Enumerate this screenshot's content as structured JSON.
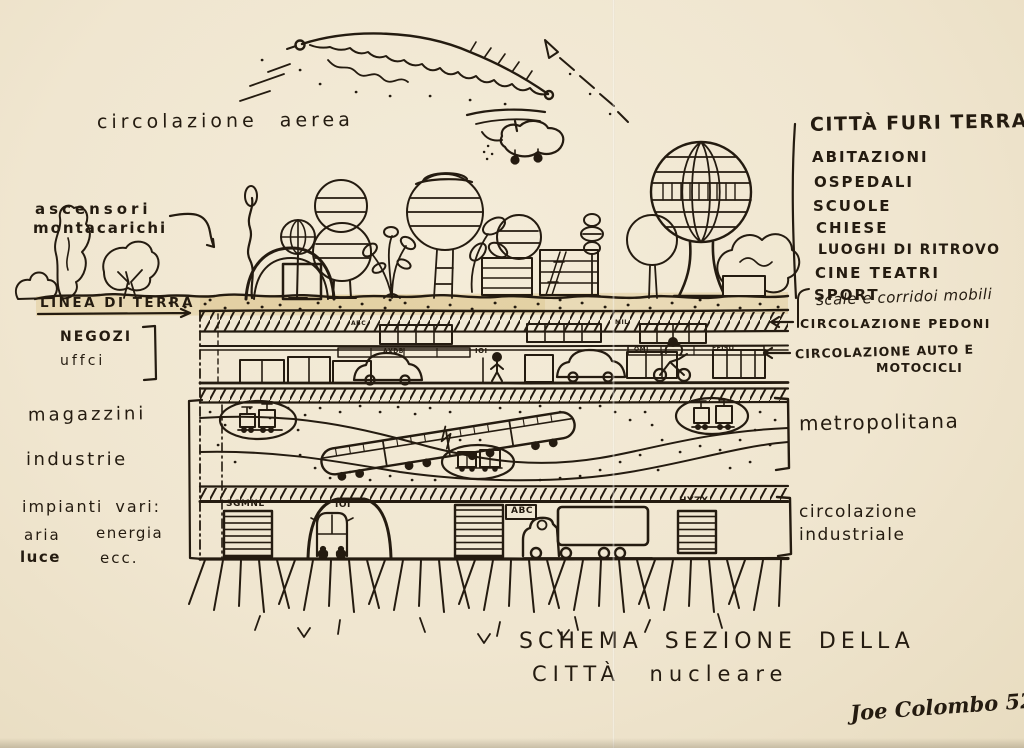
{
  "palette": {
    "paper": "#f1e7d2",
    "ink": "#241b10",
    "highlight": "#dfc995"
  },
  "sky": {
    "air_circulation": "circolazione aerea"
  },
  "above_ground": {
    "heading": "CITTÀ FURI TERRA",
    "items": [
      "ABITAZIONI",
      "OSPEDALI",
      "SCUOLE",
      "CHIESE",
      "LUOGHI DI RITROVO",
      "CINE TEATRI",
      "SPORT"
    ]
  },
  "left_annotations": {
    "elevators_line1": "ascensori",
    "elevators_line2": "montacarichi",
    "ground_line": "LINEA DI TERRA",
    "shops_line1": "NEGOZI",
    "shops_line2": "uffci",
    "warehouses": "magazzini",
    "industries": "industrie",
    "plants_heading": "impianti vari:",
    "plant_air": "aria",
    "plant_energy": "energia",
    "plant_light": "luce",
    "plant_etc": "ecc."
  },
  "right_annotations": {
    "escalators": "scale e corridoi mobili",
    "pedestrian_circulation": "CIRCOLAZIONE PEDONI",
    "auto_circulation_line1": "CIRCOLAZIONE AUTO E",
    "auto_circulation_line2": "MOTOCICLI",
    "metro": "metropolitana",
    "industrial_line1": "circolazione",
    "industrial_line2": "industriale"
  },
  "building_signs": {
    "pedestrian_level_a": "ABC",
    "pedestrian_level_b": "MIL",
    "auto_level_a": "AXDB",
    "auto_level_b": "IOI",
    "auto_level_c": "OMI",
    "auto_level_d": "FEISO",
    "industrial_door_left": "SGMNL",
    "industrial_tunnel": "IOI",
    "industrial_sign": "ABC",
    "industrial_door_right": "HYZX"
  },
  "caption": {
    "title_line1": "SCHEMA SEZIONE DELLA",
    "title_line2": "CITTÀ nucleare",
    "signature": "Joe Colombo 52"
  }
}
